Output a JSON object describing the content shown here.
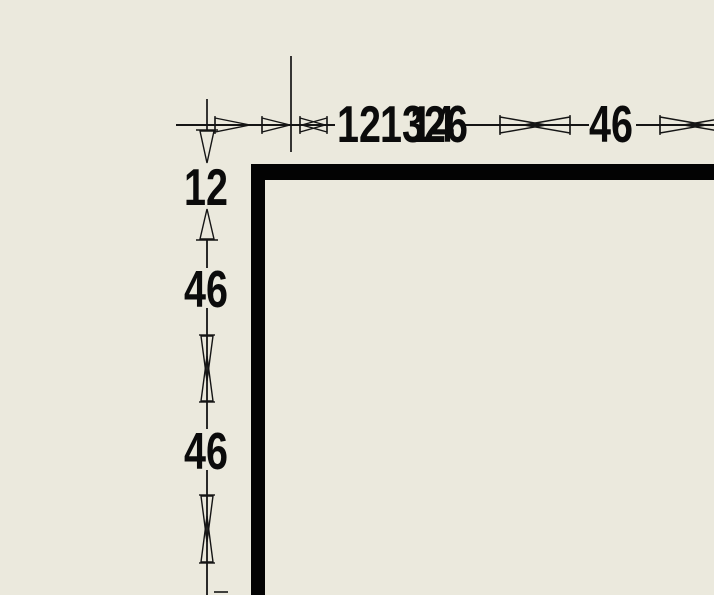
{
  "drawing": {
    "type": "cad-drawing-corner-view",
    "background_color": "#EBE9DD",
    "line_color": "#151515",
    "wall_color": "#030303",
    "wall": {
      "corner": "top-left",
      "top_edge_y": 164,
      "left_edge_x": 251,
      "thickness_px": 15
    },
    "dimensions": {
      "top_chain": {
        "orientation": "horizontal",
        "line_y": 125,
        "values": [
          "12",
          "13",
          "14",
          "26",
          "46"
        ],
        "labels": [
          {
            "text": "12",
            "x": 337,
            "y": 99
          },
          {
            "text": "13",
            "x": 380,
            "y": 99
          },
          {
            "text": "14",
            "x": 410,
            "y": 99
          },
          {
            "text": "26",
            "x": 424,
            "y": 99
          },
          {
            "text": "46",
            "x": 589,
            "y": 99
          }
        ]
      },
      "left_chain": {
        "orientation": "vertical",
        "line_x": 207,
        "values": [
          "12",
          "46",
          "46"
        ],
        "labels": [
          {
            "text": "12",
            "x": 184,
            "y": 162
          },
          {
            "text": "46",
            "x": 184,
            "y": 264
          },
          {
            "text": "46",
            "x": 184,
            "y": 426
          }
        ]
      }
    }
  }
}
